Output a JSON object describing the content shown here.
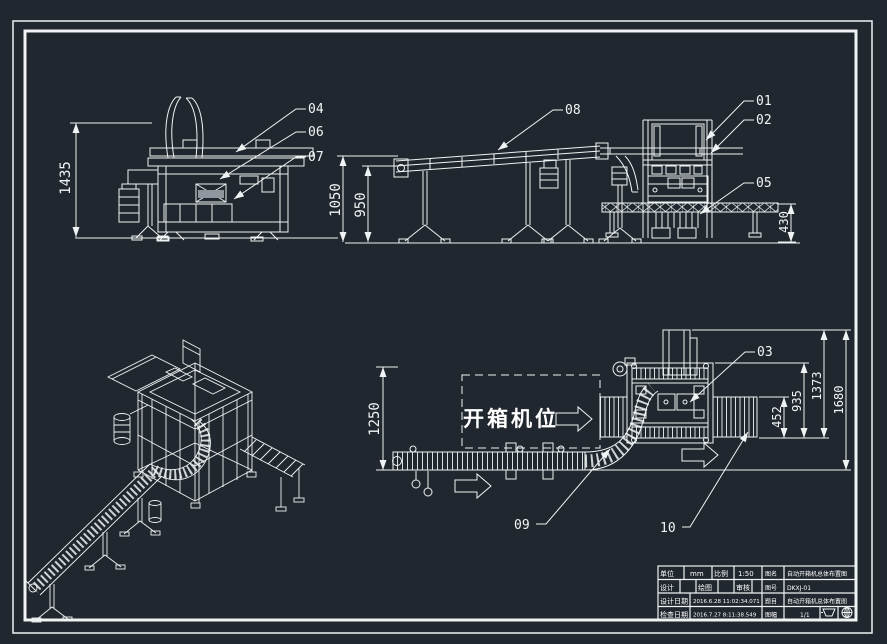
{
  "canvas": {
    "background": "#20272e",
    "line_color": "#eff3f3"
  },
  "views": {
    "side_elevation": {
      "dim_1435": "1435",
      "callout_04": "04",
      "callout_06": "06",
      "callout_07": "07"
    },
    "front_elevation": {
      "dim_1050": "1050",
      "dim_950": "950",
      "dim_430": "430",
      "callout_08": "08",
      "callout_01": "01",
      "callout_02": "02",
      "callout_05": "05"
    },
    "plan_view": {
      "dim_1250": "1250",
      "dim_452": "452",
      "dim_935": "935",
      "dim_1373": "1373",
      "dim_1680": "1680",
      "station_label": "开箱机位",
      "callout_03": "03",
      "callout_09": "09",
      "callout_10": "10"
    }
  },
  "title_block": {
    "unit_label": "单位",
    "unit_value": "mm",
    "scale_label": "比例",
    "scale_value": "1:50",
    "designer_label": "设计",
    "drafter_label": "绘图",
    "checker_label": "审核",
    "design_date_label": "设计日期",
    "design_date_value": "2016.6.28 11:02:34.071",
    "check_date_label": "检查日期",
    "check_date_value": "2016.7.27 8:11:38.549",
    "name_label": "图名",
    "name_value": "自动开箱机总体布置图",
    "number_label": "图号",
    "number_value": "DKXJ-01",
    "project_label": "题目",
    "project_value": "自动开箱机总体布置图",
    "sheet_label": "图幅",
    "sheet_value": "1/1"
  }
}
